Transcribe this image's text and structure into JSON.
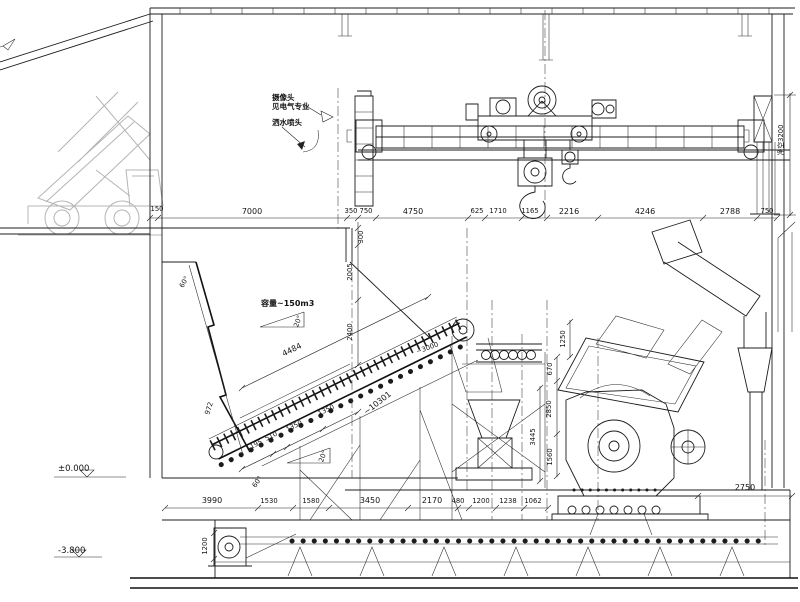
{
  "drawing": {
    "type": "section-elevation",
    "subject": "crushing-station with truck dump hopper, apron feeder, crusher and overhead crane"
  },
  "notes": {
    "camera_line1": "摄像头",
    "camera_line2": "见电气专业",
    "sprinkler": "洒水喷头",
    "capacity": "容量~150m3",
    "clearance": "净空3200"
  },
  "elevations": {
    "ground": "±0.000",
    "pit_floor": "-3.800"
  },
  "dimensions": {
    "top_row": [
      "150",
      "7000",
      "350",
      "750",
      "4750",
      "625",
      "1710",
      "1165",
      "2216",
      "4246",
      "2788",
      "750"
    ],
    "bottom_row": [
      "3990",
      "1530",
      "1580",
      "3450",
      "2170",
      "480",
      "1200",
      "1238",
      "1062"
    ],
    "right_bottom": "2750",
    "vertical_left": [
      "300",
      "2005",
      "2400"
    ],
    "vertical_center": [
      "1250",
      "670",
      "2850",
      "3445",
      "1560"
    ],
    "feeder": [
      "4484",
      "1195",
      "510",
      "1350",
      "1350",
      "~10301",
      "~3000",
      "972"
    ],
    "pit": [
      "1200"
    ],
    "angles": [
      "20°",
      "20°",
      "60°",
      "60°"
    ]
  },
  "labels": {
    "dim-150": {
      "t": "150",
      "x": 157,
      "y": 211,
      "c": "s"
    },
    "dim-7000": {
      "t": "7000",
      "x": 252,
      "y": 214
    },
    "dim-350": {
      "t": "350",
      "x": 351,
      "y": 213,
      "c": "s"
    },
    "dim-750-a": {
      "t": "750",
      "x": 366,
      "y": 213,
      "c": "s"
    },
    "dim-4750": {
      "t": "4750",
      "x": 413,
      "y": 214
    },
    "dim-625": {
      "t": "625",
      "x": 477,
      "y": 213,
      "c": "s"
    },
    "dim-1710": {
      "t": "1710",
      "x": 498,
      "y": 213,
      "c": "s"
    },
    "dim-1165": {
      "t": "1165",
      "x": 530,
      "y": 213,
      "c": "s"
    },
    "dim-2216": {
      "t": "2216",
      "x": 569,
      "y": 214
    },
    "dim-4246": {
      "t": "4246",
      "x": 645,
      "y": 214
    },
    "dim-2788": {
      "t": "2788",
      "x": 730,
      "y": 214
    },
    "dim-750-b": {
      "t": "750",
      "x": 767,
      "y": 213,
      "c": "s"
    },
    "dim-3990": {
      "t": "3990",
      "x": 212,
      "y": 503
    },
    "dim-1530": {
      "t": "1530",
      "x": 269,
      "y": 503,
      "c": "s"
    },
    "dim-1580": {
      "t": "1580",
      "x": 311,
      "y": 503,
      "c": "s"
    },
    "dim-3450": {
      "t": "3450",
      "x": 370,
      "y": 503
    },
    "dim-2170": {
      "t": "2170",
      "x": 432,
      "y": 503
    },
    "dim-480": {
      "t": "480",
      "x": 458,
      "y": 503,
      "c": "s"
    },
    "dim-1200-a": {
      "t": "1200",
      "x": 481,
      "y": 503,
      "c": "s"
    },
    "dim-1238": {
      "t": "1238",
      "x": 508,
      "y": 503,
      "c": "s"
    },
    "dim-1062": {
      "t": "1062",
      "x": 533,
      "y": 503,
      "c": "s"
    },
    "dim-2750": {
      "t": "2750",
      "x": 745,
      "y": 490
    },
    "dim-300": {
      "t": "300",
      "x": 363,
      "y": 237,
      "c": "s",
      "r": -90
    },
    "dim-2005": {
      "t": "2005",
      "x": 352,
      "y": 272,
      "c": "s",
      "r": -90
    },
    "dim-2400": {
      "t": "2400",
      "x": 352,
      "y": 332,
      "c": "s",
      "r": -90
    },
    "dim-1250": {
      "t": "1250",
      "x": 565,
      "y": 339,
      "c": "s",
      "r": -90
    },
    "dim-670": {
      "t": "670",
      "x": 552,
      "y": 369,
      "c": "s",
      "r": -90
    },
    "dim-2850": {
      "t": "2850",
      "x": 551,
      "y": 409,
      "c": "s",
      "r": -90
    },
    "dim-3445": {
      "t": "3445",
      "x": 535,
      "y": 437,
      "c": "s",
      "r": -90
    },
    "dim-1560": {
      "t": "1560",
      "x": 552,
      "y": 457,
      "c": "s",
      "r": -90
    },
    "dim-1200-b": {
      "t": "1200",
      "x": 207,
      "y": 546,
      "c": "s",
      "r": -90
    },
    "dim-972": {
      "t": "972",
      "x": 211,
      "y": 409,
      "c": "s",
      "r": -72
    },
    "dim-clearance": {
      "t": "净空3200",
      "x": 783,
      "y": 140,
      "c": "s",
      "r": -90
    },
    "dim-4484": {
      "t": "4484",
      "x": 293,
      "y": 352,
      "r": -26
    },
    "dim-1195": {
      "t": "1195",
      "x": 255,
      "y": 447,
      "c": "s",
      "r": -26
    },
    "dim-510": {
      "t": "510",
      "x": 272,
      "y": 438,
      "c": "s",
      "r": -26
    },
    "dim-1350-a": {
      "t": "1350",
      "x": 295,
      "y": 428,
      "c": "s",
      "r": -26
    },
    "dim-1350-b": {
      "t": "1350",
      "x": 327,
      "y": 412,
      "c": "s",
      "r": -26
    },
    "dim-10301": {
      "t": "~10301",
      "x": 379,
      "y": 405,
      "r": -38
    },
    "dim-3000": {
      "t": "~3000",
      "x": 428,
      "y": 350,
      "c": "s",
      "r": -20
    },
    "angle-20-upper": {
      "t": "20°",
      "x": 300,
      "y": 322,
      "c": "s",
      "r": -70
    },
    "angle-20-lower": {
      "t": "20°",
      "x": 325,
      "y": 457,
      "c": "s",
      "r": -70
    },
    "angle-60-upper": {
      "t": "60°",
      "x": 186,
      "y": 283,
      "c": "s",
      "r": -60
    },
    "angle-60-lower": {
      "t": "60°",
      "x": 259,
      "y": 483,
      "c": "s",
      "r": -55
    },
    "note-camera-1": {
      "t": "摄像头",
      "x": 272,
      "y": 100,
      "c": "n"
    },
    "note-camera-2": {
      "t": "见电气专业",
      "x": 272,
      "y": 109,
      "c": "n"
    },
    "note-sprinkler": {
      "t": "洒水喷头",
      "x": 272,
      "y": 125,
      "c": "n"
    },
    "note-capacity": {
      "t": "容量~150m3",
      "x": 261,
      "y": 306,
      "c": "n2"
    },
    "elev-zero": {
      "t": "±0.000",
      "x": 58,
      "y": 471,
      "c": "e"
    },
    "elev-pit": {
      "t": "-3.800",
      "x": 58,
      "y": 553,
      "c": "e"
    }
  }
}
